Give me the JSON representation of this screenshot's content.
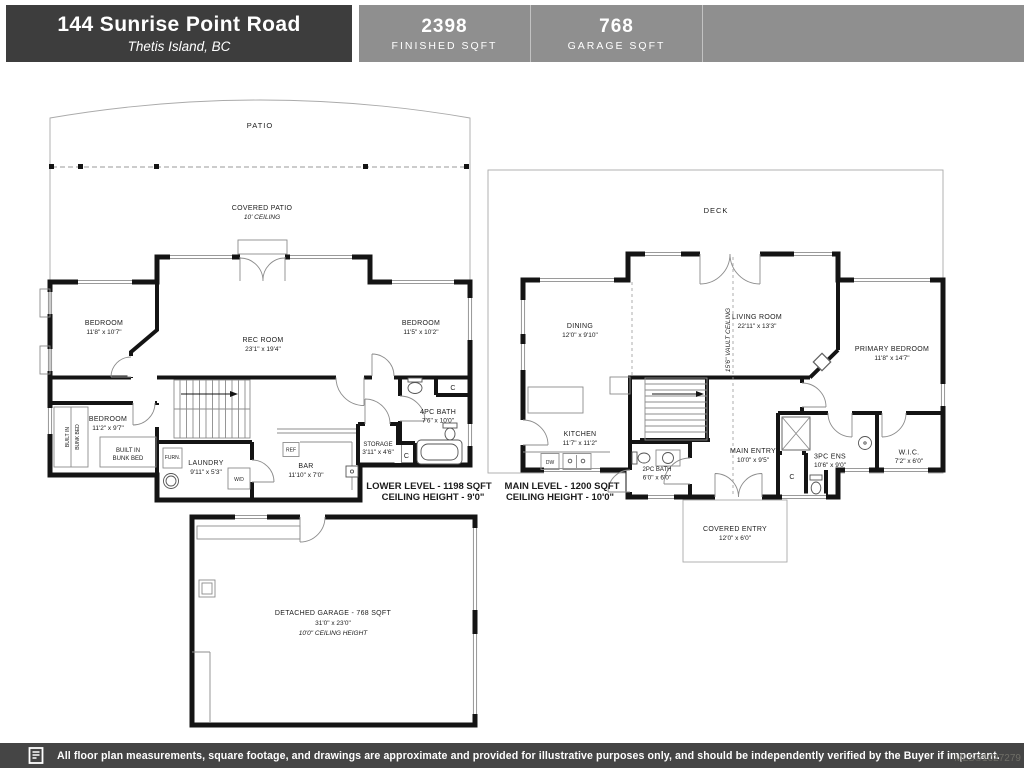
{
  "colors": {
    "header_bg": "#3d3d3d",
    "stats_bg": "#8f8f8f",
    "footer_bg": "#454545",
    "wall": "#141414"
  },
  "header": {
    "address": "144 Sunrise Point Road",
    "city": "Thetis Island, BC",
    "stats": [
      {
        "value": "2398",
        "label": "FINISHED SQFT"
      },
      {
        "value": "768",
        "label": "GARAGE SQFT"
      }
    ]
  },
  "lower": {
    "patio": "PATIO",
    "covered_patio": "COVERED PATIO",
    "covered_patio_sub": "10' CEILING",
    "bedroom1": {
      "name": "BEDROOM",
      "dims": "11'8\" x 10'7\""
    },
    "rec": {
      "name": "REC ROOM",
      "dims": "23'1\" x 19'4\""
    },
    "bedroom2": {
      "name": "BEDROOM",
      "dims": "11'5\" x 10'2\""
    },
    "bath": {
      "name": "4PC BATH",
      "dims": "7'6\" x 10'0\""
    },
    "storage": {
      "name": "STORAGE",
      "dims": "3'11\" x 4'6\""
    },
    "bedroom3": {
      "name": "BEDROOM",
      "dims": "11'2\" x 9'7\""
    },
    "bunk_line1": "BUILT IN",
    "bunk_line2": "BUNK BED",
    "furn": "FURN.",
    "wd": "W/D",
    "ref": "REF",
    "laundry": {
      "name": "LAUNDRY",
      "dims": "9'11\" x 5'3\""
    },
    "bar": {
      "name": "BAR",
      "dims": "11'10\" x 7'0\""
    },
    "closet": "C",
    "caption1": "LOWER LEVEL - 1198 SQFT",
    "caption2": "CEILING HEIGHT - 9'0\""
  },
  "main": {
    "deck": "DECK",
    "vault": "15'6\" VAULT CEILING",
    "dining": {
      "name": "DINING",
      "dims": "12'0\" x 9'10\""
    },
    "kitchen": {
      "name": "KITCHEN",
      "dims": "11'7\" x 11'2\""
    },
    "living": {
      "name": "LIVING ROOM",
      "dims": "22'11\" x 13'3\""
    },
    "primary": {
      "name": "PRIMARY BEDROOM",
      "dims": "11'8\" x 14'7\""
    },
    "entry": {
      "name": "MAIN ENTRY",
      "dims": "10'0\" x 9'5\""
    },
    "bath2": {
      "name": "2PC BATH",
      "dims": "6'0\" x 6'0\""
    },
    "ens": {
      "name": "3PC ENS",
      "dims": "10'6\" x 9'0\""
    },
    "wic": {
      "name": "W.I.C.",
      "dims": "7'2\" x 6'0\""
    },
    "covered_entry": {
      "name": "COVERED ENTRY",
      "dims": "12'0\" x 6'0\""
    },
    "dw": "DW",
    "closet": "C",
    "caption1": "MAIN LEVEL - 1200 SQFT",
    "caption2": "CEILING HEIGHT - 10'0\""
  },
  "garage": {
    "line1": "DETACHED GARAGE - 768 SQFT",
    "line2": "31'0\" x 23'0\"",
    "line3": "10'0\" CEILING HEIGHT"
  },
  "footer": {
    "disclaimer": "All floor plan measurements, square footage, and drawings are approximate and provided for illustrative purposes only, and should be independently verified by the Buyer if important.",
    "mls": "MLS®1027279"
  }
}
